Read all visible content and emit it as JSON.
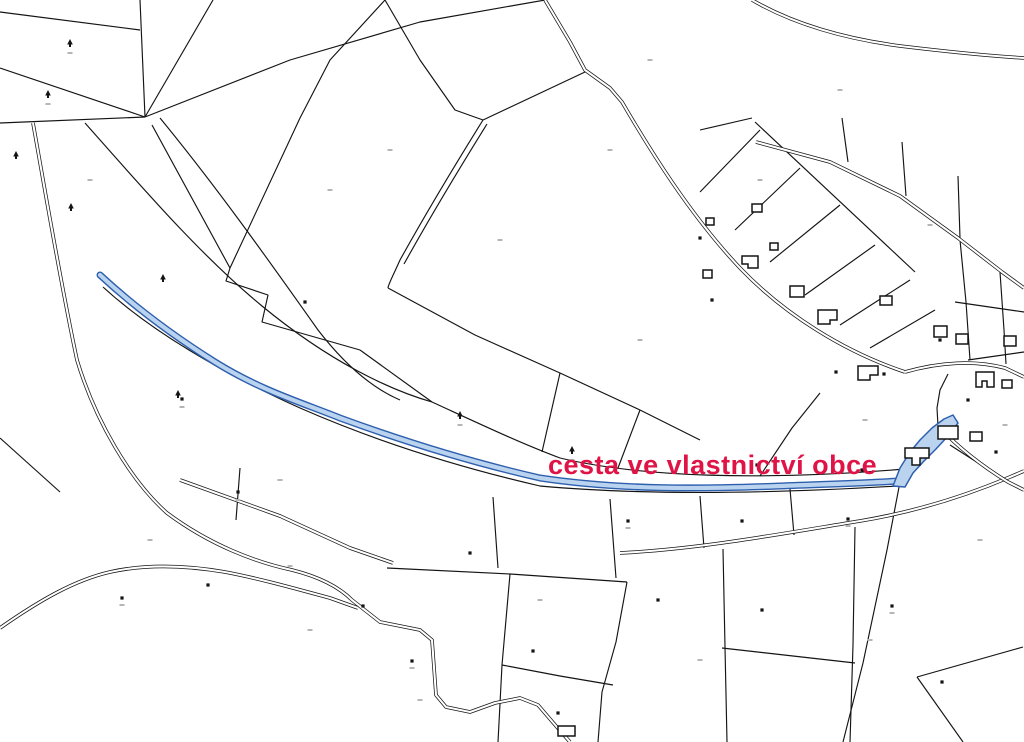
{
  "map": {
    "kind": "cadastral-parcel-map",
    "annotation": {
      "text": "cesta ve vlastnictví obce",
      "color": "#e01347"
    },
    "colors": {
      "background": "#ffffff",
      "boundary": "#141414",
      "road_fill": "#ffffff",
      "speck": "#b5b5b5"
    },
    "highlight_route": {
      "name": "municipal-road-highlight",
      "stroke": "#2e5fae",
      "fill": "#bad4ef",
      "path": "M100,275 C140,312 180,340 215,362 C260,390 300,402 340,418 C400,440 470,462 540,478 C620,490 700,489 780,486 C830,484 870,483 898,481",
      "pond": "M893,486 L900,468 L910,452 L920,440 L932,428 L944,419 L953,415 L958,423 L948,436 L936,449 L924,461 L913,473 L905,487 Z"
    },
    "parcel_lines": [
      "M0,12 L140,30",
      "M0,68 L145,117",
      "M140,0 L145,117",
      "M145,117 L213,0",
      "M145,117 L290,60 L420,22 L545,0",
      "M0,123 L145,117",
      "M85,123 C140,185 200,255 262,306 C330,362 390,390 432,402",
      "M160,118 C215,185 265,255 318,330 C345,365 372,388 400,400",
      "M152,125 L230,268",
      "M230,268 L300,118 L330,60 L385,0",
      "M230,268 L226,281 L268,295 L262,322 L360,350",
      "M360,350 L432,402",
      "M483,120 C455,165 425,215 400,260 C392,278 388,285 388,288",
      "M487,124 C459,169 429,219 404,264",
      "M483,120 L585,72",
      "M385,0 L420,60 L455,110 L483,120",
      "M388,288 L475,335 L560,373 L640,410 L700,440",
      "M560,373 L542,452",
      "M640,410 L618,468",
      "M760,476 L792,428 L820,393",
      "M432,402 C480,424 520,443 560,458 C640,477 760,481 905,469",
      "M103,287 C150,330 220,372 300,408 C380,443 462,468 540,486 C650,496 780,493 898,486",
      "M493,497 L498,568",
      "M610,499 L616,578",
      "M700,496 L704,548",
      "M790,489 L794,535",
      "M240,468 L236,520",
      "M387,568 L510,574 L627,582",
      "M510,574 L502,665 L498,742",
      "M627,582 L616,642 L602,692 L598,742",
      "M502,665 L560,676 L613,685",
      "M723,549 L725,647 L727,742",
      "M855,527 L853,645 L850,742",
      "M722,648 L855,663",
      "M917,677 L963,742",
      "M917,677 L1023,647",
      "M900,482 L887,550 L863,663 L843,742",
      "M0,438 L30,465 L60,492",
      "M755,122 L915,272",
      "M700,130 L752,118",
      "M842,118 L848,162",
      "M902,142 L906,196",
      "M958,176 L960,238",
      "M700,192 L760,130",
      "M735,230 L800,168",
      "M770,262 L840,205",
      "M805,295 L875,245",
      "M840,325 L910,280",
      "M870,348 L935,310",
      "M960,240 L966,302 L970,360",
      "M1000,272 L1004,330 L1006,364",
      "M955,302 L1024,312",
      "M968,360 L1024,352",
      "M950,445 L1000,477 L1024,490",
      "M938,426 L937,408 L940,390 L948,374"
    ],
    "roads": [
      "M752,0 C790,22 840,38 900,46 C950,52 990,56 1024,58",
      "M756,142 L830,162 L900,196 L958,238 L1002,272 L1024,288",
      "M545,0 L570,42 L585,70 L610,88 L622,102 C650,150 690,215 740,268 C785,315 845,352 905,372",
      "M905,372 C940,362 975,360 1005,368 L1024,377",
      "M33,123 C45,190 60,280 77,360 C95,420 130,480 167,513 C210,545 255,562 292,570 C320,577 340,588 352,600 L380,622 L420,630 L432,640 L436,695 L446,707 L470,712 L495,703 L520,698 L538,705 L556,726 L570,742",
      "M0,628 C40,600 75,580 110,572 C150,563 190,566 225,572 C262,579 300,590 330,598 L358,608",
      "M180,480 L280,516 L350,548 L393,563",
      "M620,553 C700,549 780,534 860,521 C920,511 970,494 1010,477 L1024,471",
      "M940,428 C958,447 982,466 1008,482 L1024,490"
    ],
    "buildings": [
      "M742,256 h16 v12 h-10 v-4 h-6 z",
      "M790,286 h14 v11 h-14 z",
      "M703,270 h9 v8 h-9 z",
      "M818,310 h19 v10 h-7 v4 h-12 z",
      "M858,366 h20 v9 h-8 v5 h-12 z",
      "M752,204 h10 v8 h-10 z",
      "M706,218 h8 v7 h-8 z",
      "M770,243 h8 v7 h-8 z",
      "M880,296 h12 v9 h-12 z",
      "M934,326 h13 v11 h-13 z",
      "M956,334 h12 v10 h-12 z",
      "M1004,336 h12 v10 h-12 z",
      "M976,372 h18 v15 h-7 v-6 h-5 v6 h-6 z",
      "M1002,380 h10 v8 h-10 z",
      "M938,426 h20 v13 h-20 z",
      "M905,448 h24 v10 h-9 v7 h-8 v-7 h-7 z",
      "M970,432 h12 v9 h-12 z",
      "M558,726 h17 v10 h-17 z"
    ],
    "tree_symbols": [
      [
        70,
        45
      ],
      [
        48,
        96
      ],
      [
        16,
        157
      ],
      [
        71,
        209
      ],
      [
        163,
        280
      ],
      [
        178,
        396
      ],
      [
        460,
        417
      ],
      [
        572,
        452
      ]
    ],
    "dot_markers": [
      [
        182,
        399
      ],
      [
        238,
        492
      ],
      [
        122,
        598
      ],
      [
        208,
        585
      ],
      [
        363,
        606
      ],
      [
        412,
        661
      ],
      [
        470,
        553
      ],
      [
        533,
        651
      ],
      [
        558,
        713
      ],
      [
        628,
        521
      ],
      [
        658,
        600
      ],
      [
        742,
        521
      ],
      [
        762,
        610
      ],
      [
        848,
        519
      ],
      [
        892,
        606
      ],
      [
        942,
        682
      ],
      [
        700,
        238
      ],
      [
        712,
        300
      ],
      [
        836,
        372
      ],
      [
        884,
        374
      ],
      [
        940,
        340
      ],
      [
        968,
        400
      ],
      [
        996,
        452
      ],
      [
        757,
        465
      ],
      [
        862,
        470
      ],
      [
        305,
        302
      ]
    ],
    "label_specks": [
      [
        70,
        53
      ],
      [
        48,
        104
      ],
      [
        460,
        425
      ],
      [
        572,
        460
      ],
      [
        182,
        407
      ],
      [
        238,
        500
      ],
      [
        500,
        240
      ],
      [
        650,
        60
      ],
      [
        840,
        90
      ],
      [
        930,
        225
      ],
      [
        390,
        150
      ],
      [
        90,
        180
      ],
      [
        280,
        480
      ],
      [
        640,
        340
      ],
      [
        760,
        180
      ],
      [
        980,
        540
      ],
      [
        700,
        660
      ],
      [
        420,
        700
      ],
      [
        870,
        640
      ],
      [
        540,
        600
      ],
      [
        310,
        630
      ],
      [
        150,
        540
      ],
      [
        1005,
        425
      ],
      [
        865,
        420
      ],
      [
        330,
        190
      ],
      [
        610,
        150
      ],
      [
        290,
        566
      ],
      [
        412,
        668
      ],
      [
        628,
        528
      ],
      [
        848,
        526
      ],
      [
        122,
        605
      ],
      [
        892,
        613
      ]
    ]
  }
}
